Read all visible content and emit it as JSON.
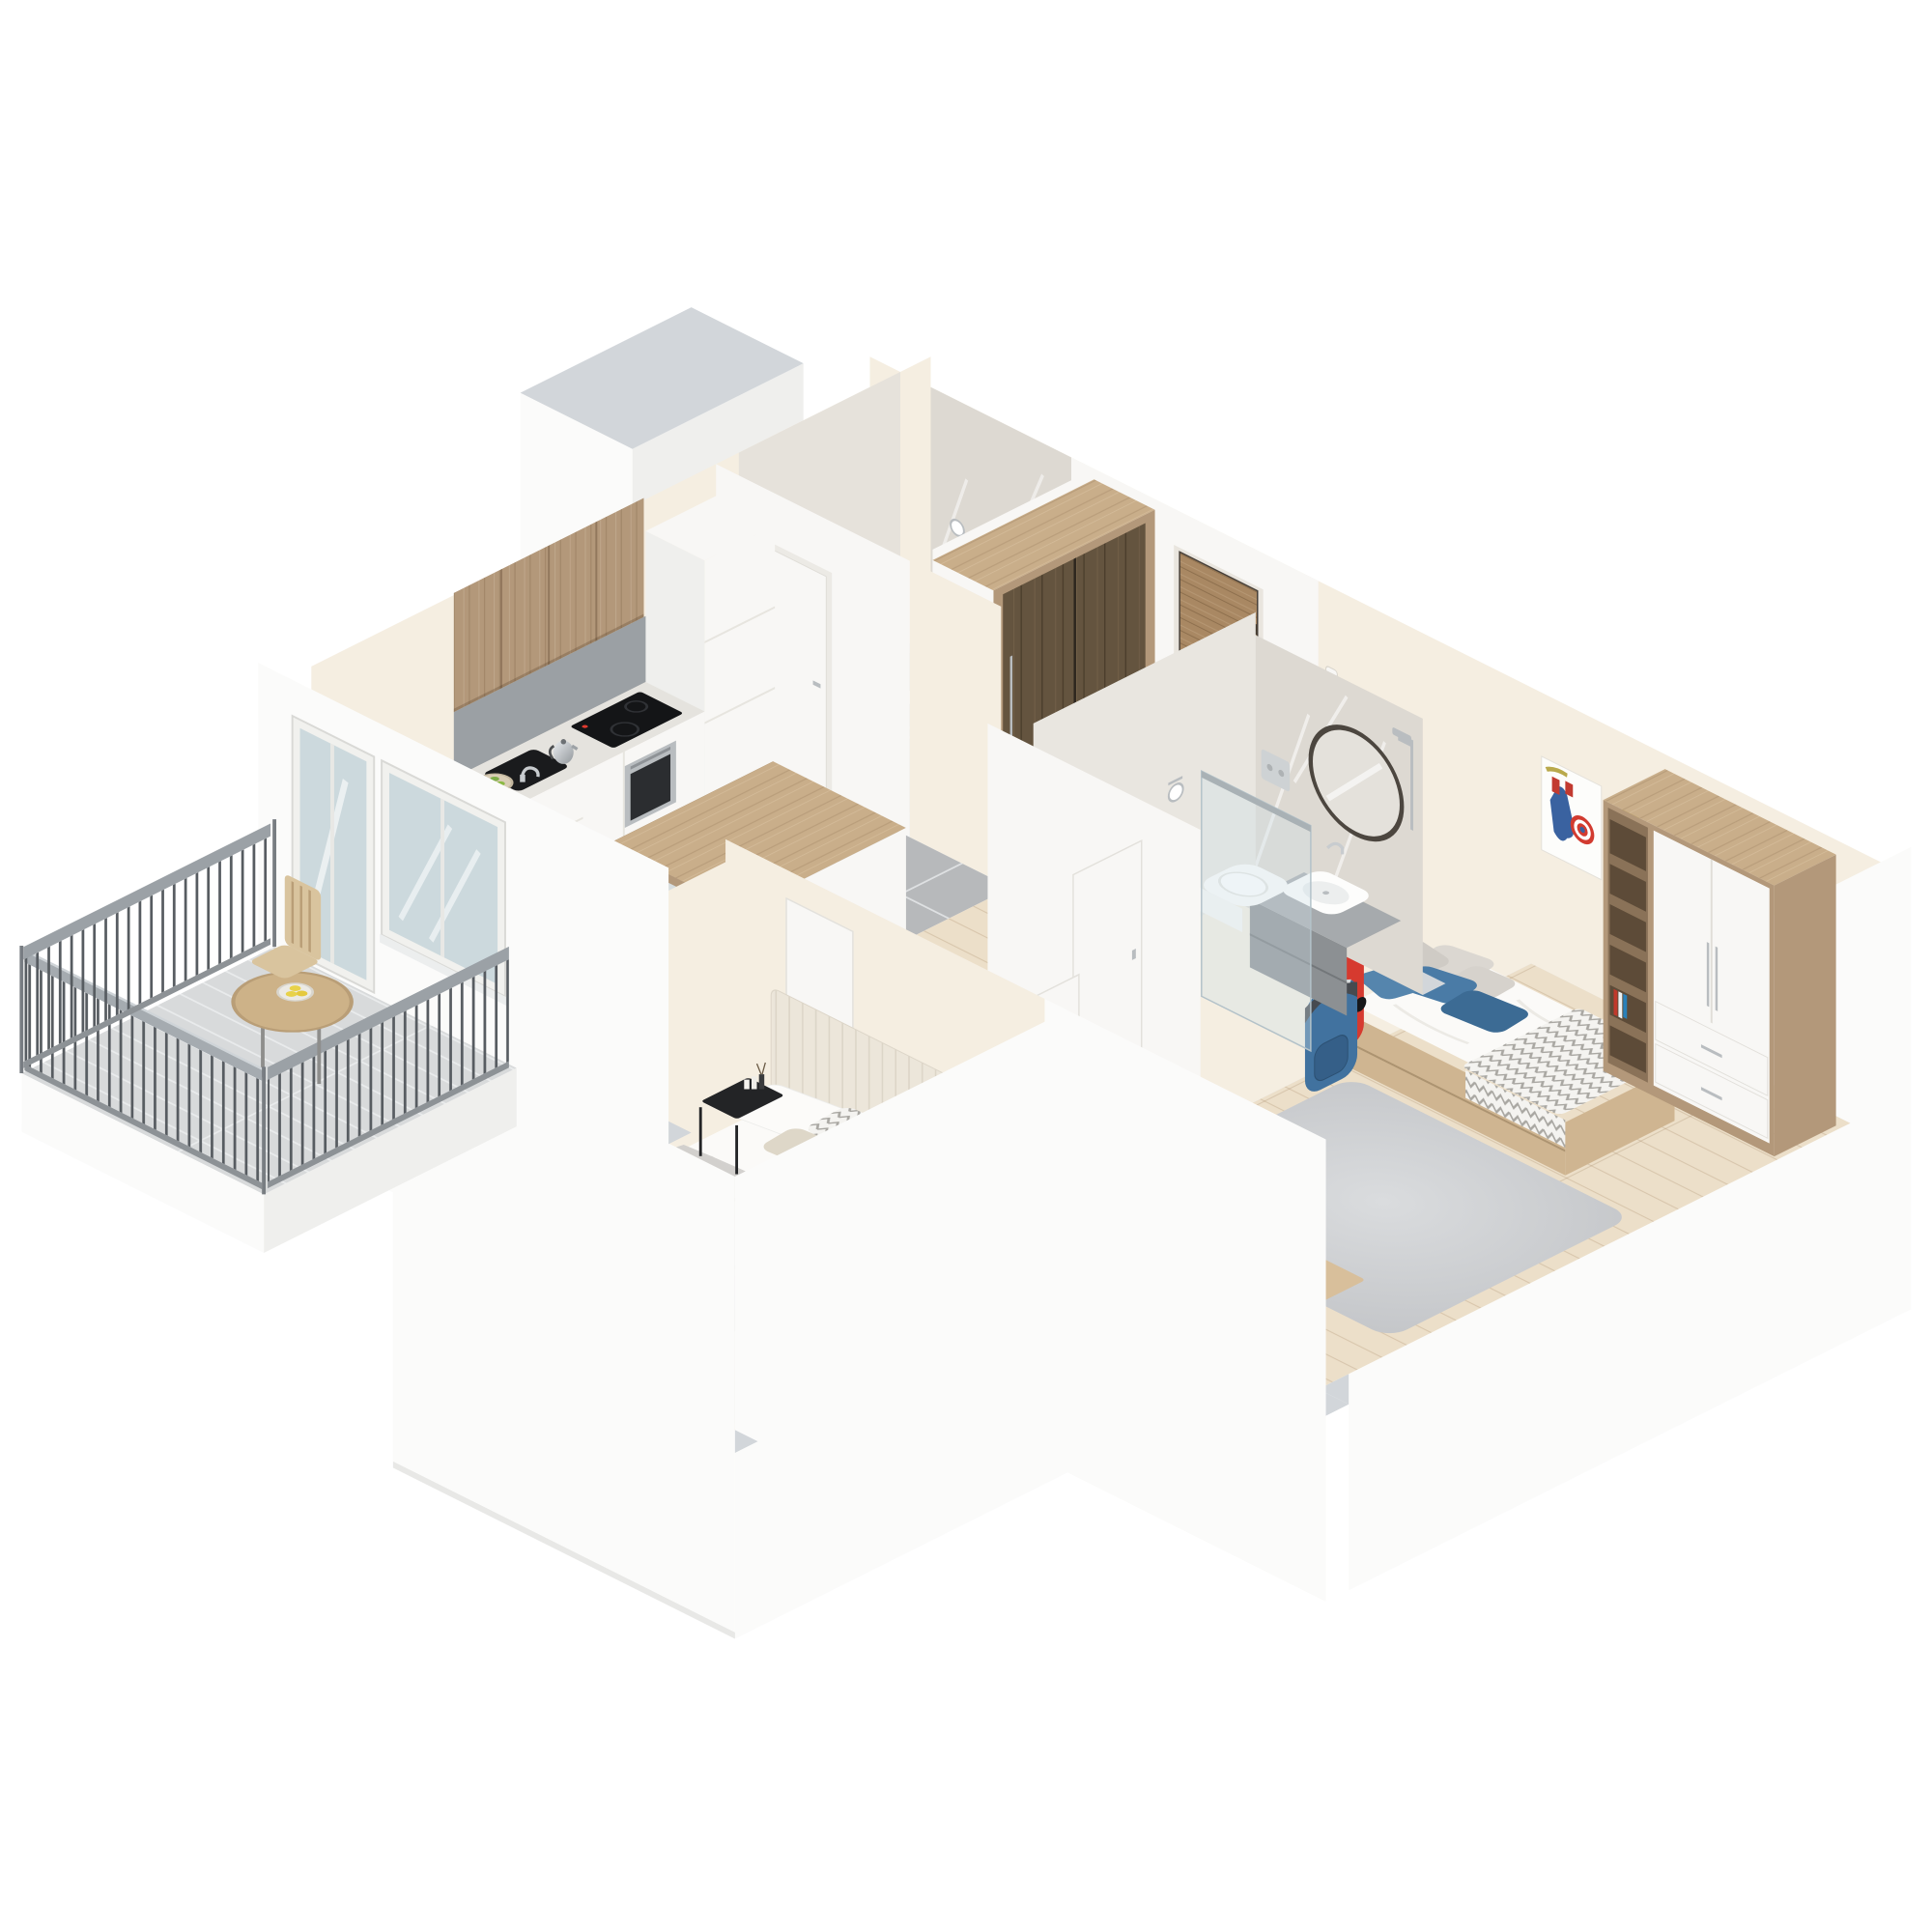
{
  "meta": {
    "title": "Isometric 3D cutaway floor plan — one-bedroom apartment with kids room and balcony",
    "view": "isometric top-down cutaway render",
    "background": "#ffffff"
  },
  "palette": {
    "wallTop": "#d2d6da",
    "ext": "#fbfbfa",
    "extShade": "#efefed",
    "cream": "#f5eee1",
    "white": "#f8f7f5",
    "marble": "#ddd9d2",
    "woodCab": "#b3987a",
    "woodTop": "#c9ae8a",
    "woodLight": "#cfb591",
    "floorWood": "#ecdfc9",
    "floorTile": "#b7b9bb",
    "bathTile": "#d3ccc1",
    "balconyFloor": "#d8dadb",
    "blue": "#4a7ba6",
    "blueDark": "#3c6b94",
    "red": "#d63a2f",
    "black": "#1d1e20",
    "steel": "#b9bdc0",
    "mattress": "#fbfaf8",
    "blanket": "#c8c6c3",
    "glass": "#ccd9dd",
    "lemon": "#e8d24a",
    "apple": "#7fae4a"
  },
  "scene": {
    "rooms": [
      {
        "name": "kitchen-living-dining",
        "items": [
          "wood upper cabinets",
          "gray backsplash",
          "tall white cabinet column",
          "white base cabinets",
          "black induction cooktop with red display",
          "built-in stainless oven",
          "electric kettle",
          "black sink with chrome faucet",
          "bowl of green apples",
          "gray porcelain tile floor",
          "white dining table",
          "two gray chairs",
          "wood-framed mirror wardrobe"
        ]
      },
      {
        "name": "hallway",
        "items": [
          "wood entrance door",
          "wardrobe with dark mirror doors",
          "white console",
          "intercom handset",
          "oak plank floor"
        ]
      },
      {
        "name": "wc",
        "items": [
          "compact toilet",
          "toilet paper holder",
          "marble wall tiles",
          "white door"
        ]
      },
      {
        "name": "bathroom",
        "items": [
          "round black-rim mirror",
          "white vessel sink on gray vanity",
          "chrome faucet",
          "wall-hung toilet with chrome flush plate",
          "glass shower screen",
          "rain shower column",
          "toilet paper holder",
          "marble walls"
        ]
      },
      {
        "name": "kids-room",
        "items": [
          "single bed with storage drawers",
          "blue and gray pillows",
          "zigzag plaid",
          "Captain America poster",
          "Spider-Man poster",
          "red skateboard",
          "blue backpack",
          "shelving unit with white wardrobe and drawers",
          "study desk",
          "silver desk lamp",
          "blue armchair",
          "gray rug"
        ]
      },
      {
        "name": "master-bedroom",
        "items": [
          "double bed with channel-tufted headboard",
          "white and gray pillows",
          "gray throw blanket",
          "two black metal nightstands",
          "candles and reed diffuser",
          "vase with sprigs",
          "gray tub armchair",
          "light rug",
          "potted plant",
          "white interior doors"
        ]
      },
      {
        "name": "balcony",
        "items": [
          "steel rod railing",
          "round wooden bistro table",
          "bowl of lemons",
          "wooden slat chair",
          "glazed balcony door and window"
        ]
      }
    ],
    "structure": [
      "light-gray capped cut walls",
      "white exterior slab skirt",
      "isometric camera"
    ]
  }
}
